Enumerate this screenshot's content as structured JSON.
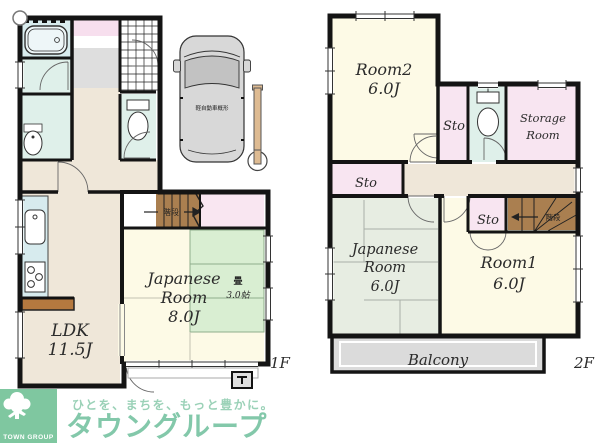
{
  "floor1": {
    "label": "1F",
    "ldk1": "LDK",
    "ldk2": "11.5J",
    "jr1": "Japanese",
    "jr2": "Room",
    "jr3": "8.0J",
    "tatami": "畳",
    "tatami_size": "3.0帖",
    "stairs": "階段",
    "car": "軽自動車概形"
  },
  "floor2": {
    "label": "2F",
    "room2": "Room2",
    "room2_size": "6.0J",
    "room1": "Room1",
    "room1_size": "6.0J",
    "jr1": "Japanese",
    "jr2": "Room",
    "jr3": "6.0J",
    "sto_top": "Sto",
    "sto_mid": "Sto",
    "sto_bottom": "Sto",
    "storage1": "Storage",
    "storage2": "Room",
    "balcony": "Balcony",
    "stairs": "階段"
  },
  "watermark": {
    "tagline": "ひとを、まちを、もっと豊かに。",
    "brand": "タウングループ",
    "logo": "TOWN GROUP"
  },
  "colors": {
    "wall": "#141414",
    "room_cream": "#fdfae6",
    "closet_pink": "#f8e5f1",
    "wet_area_aqua": "#dff0ea",
    "tatami_green_1f": "#d9eed2",
    "tatami_gray_2f": "#e7ede2",
    "hall_beige": "#efe7d9",
    "stairs_brown": "#aa7f50",
    "balcony_gray": "#dbdbdb",
    "brand_green": "#7cc5a5"
  }
}
